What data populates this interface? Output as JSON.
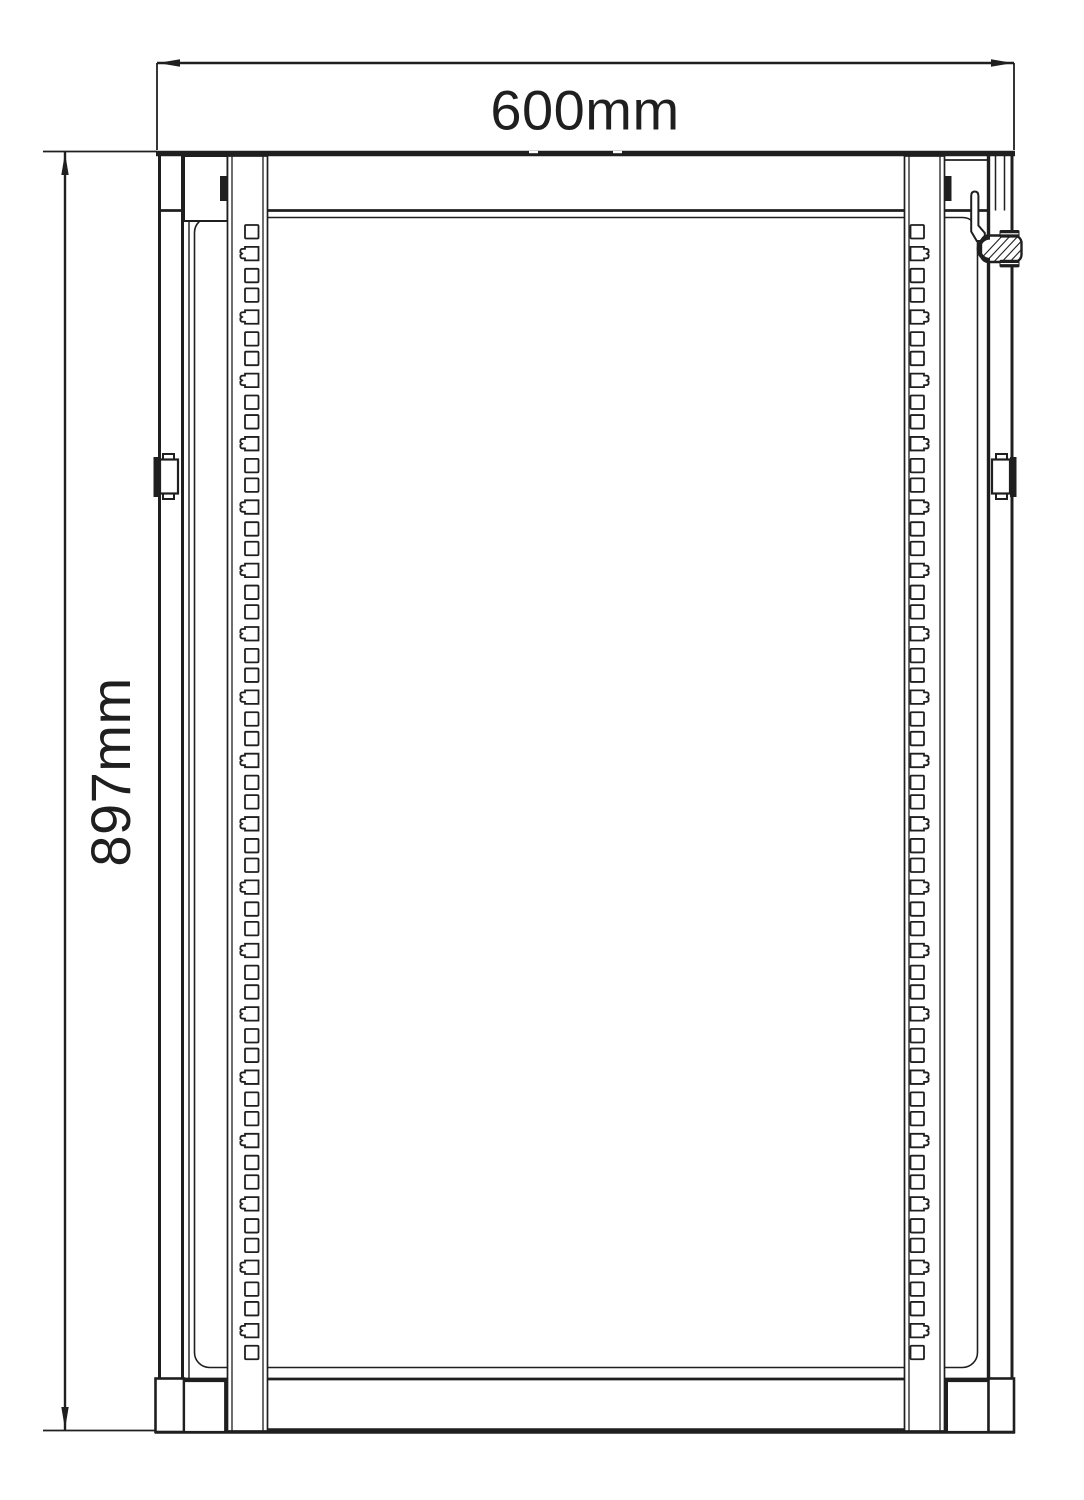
{
  "dimensions": {
    "width": {
      "label": "600mm"
    },
    "height": {
      "label": "897mm"
    }
  },
  "style": {
    "ink": "#1f1f1f",
    "background": "#ffffff"
  },
  "rack": {
    "rail_units": 18,
    "holes_per_unit": 3,
    "unit_pitch": 63.35,
    "hole_offsets": [
      0,
      21.9,
      43.8
    ],
    "hole_size": 13.5,
    "first_hole_top": 225,
    "notched_hole_index": 1,
    "left_rail": {
      "hole_x": 245,
      "notch_side": "left"
    },
    "right_rail": {
      "hole_x": 910.5,
      "notch_side": "right"
    }
  }
}
